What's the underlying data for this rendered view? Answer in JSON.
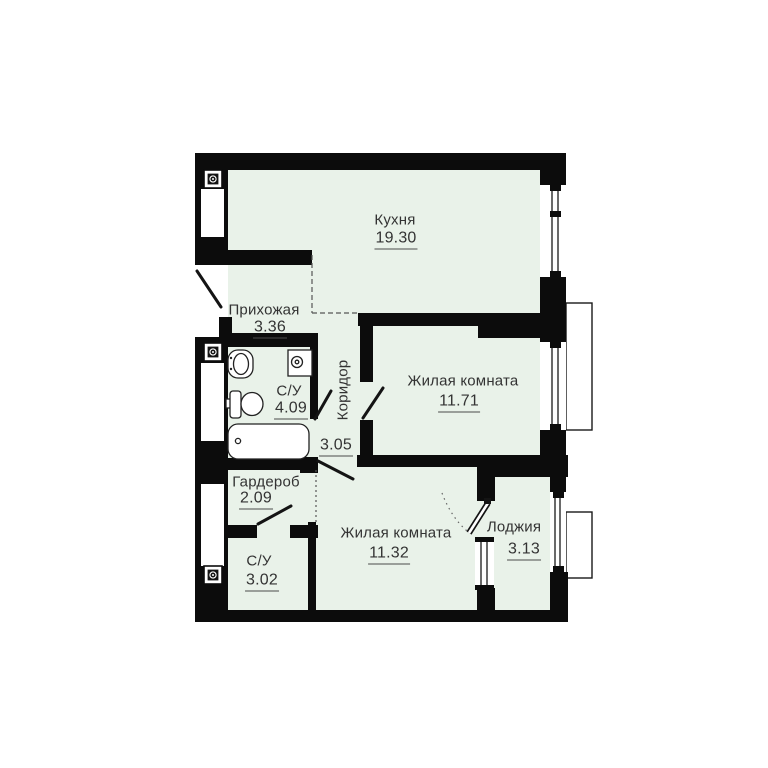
{
  "rooms": [
    {
      "id": "kitchen",
      "name": "Кухня",
      "area": "19.30"
    },
    {
      "id": "hallway",
      "name": "Прихожая",
      "area": "3.36"
    },
    {
      "id": "bathroom-1",
      "name": "С/У",
      "area": "4.09"
    },
    {
      "id": "corridor",
      "name": "Коридор",
      "area": "3.05"
    },
    {
      "id": "living-1",
      "name": "Жилая комната",
      "area": "11.71"
    },
    {
      "id": "wardrobe",
      "name": "Гардероб",
      "area": "2.09"
    },
    {
      "id": "bathroom-2",
      "name": "С/У",
      "area": "3.02"
    },
    {
      "id": "living-2",
      "name": "Жилая комната",
      "area": "11.32"
    },
    {
      "id": "loggia",
      "name": "Лоджия",
      "area": "3.13"
    }
  ],
  "colors": {
    "wall": "#0c0c0c",
    "floor": "#e9f2e9",
    "text": "#333333"
  },
  "symbols": [
    "ventilation-shaft",
    "sink",
    "toilet",
    "bathtub",
    "washing-machine",
    "window",
    "door-leaf",
    "balcony-slab",
    "dashed-zone-boundary"
  ]
}
